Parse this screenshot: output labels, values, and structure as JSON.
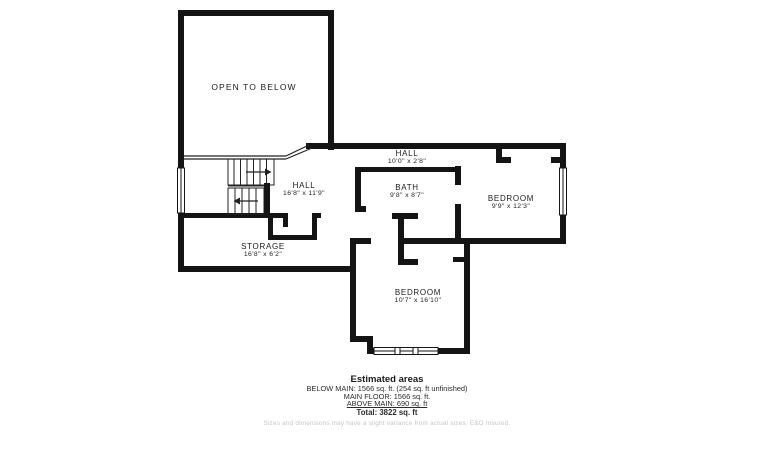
{
  "plan": {
    "rooms": [
      {
        "name": "OPEN TO BELOW",
        "dims": ""
      },
      {
        "name": "HALL",
        "dims": "16'8\" x 11'9\""
      },
      {
        "name": "STORAGE",
        "dims": "16'8\" x 6'2\""
      },
      {
        "name": "HALL",
        "dims": "10'0\" x 2'8\""
      },
      {
        "name": "BATH",
        "dims": "9'8\" x 8'7\""
      },
      {
        "name": "BEDROOM",
        "dims": "9'9\" x 12'3\""
      },
      {
        "name": "BEDROOM",
        "dims": "10'7\" x 16'10\""
      }
    ]
  },
  "estimated_areas": {
    "title": "Estimated areas",
    "below_main": "BELOW MAIN: 1566 sq. ft. (254 sq. ft unfinished)",
    "main_floor": "MAIN FLOOR: 1566 sq. ft.",
    "above_main": "ABOVE MAIN: 690 sq. ft",
    "total": "Total: 3822 sq. ft",
    "disclaimer": "Sizes and dimensions may have a slight variance from actual sizes. E&O Insured."
  },
  "colors": {
    "wall": "#141414",
    "thin_line": "#222222",
    "text": "#1c1c1c",
    "disclaimer_text": "#c6c6c6",
    "background": "#ffffff"
  }
}
